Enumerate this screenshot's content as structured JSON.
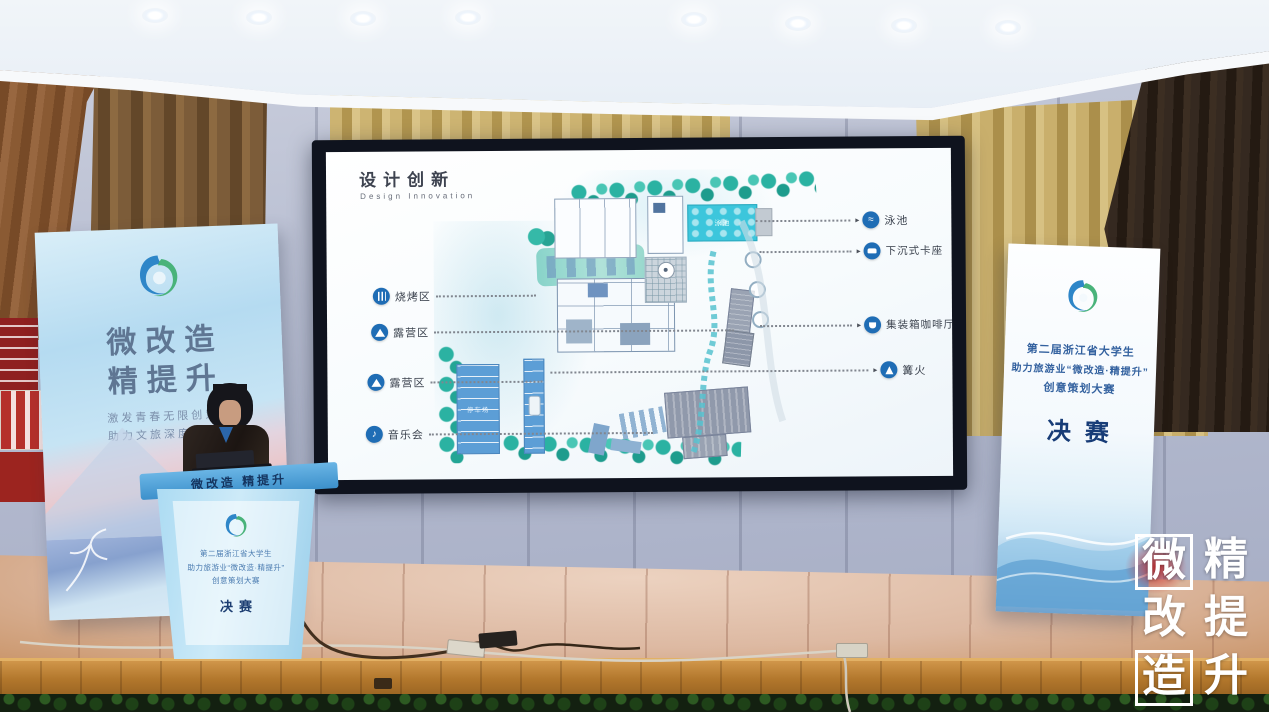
{
  "slide": {
    "title": "设计创新",
    "subtitle": "Design Innovation",
    "left_labels": [
      {
        "icon": "grill-icon",
        "label": "烧烤区"
      },
      {
        "icon": "tent-icon",
        "label": "露营区"
      },
      {
        "icon": "tent-icon",
        "label": "露营区"
      },
      {
        "icon": "music-icon",
        "label": "音乐会"
      }
    ],
    "right_labels": [
      {
        "icon": "swim-icon",
        "label": "泳池"
      },
      {
        "icon": "seat-icon",
        "label": "下沉式卡座"
      },
      {
        "icon": "coffee-icon",
        "label": "集装箱咖啡厅"
      },
      {
        "icon": "fire-icon",
        "label": "篝火"
      }
    ],
    "plan": {
      "pool_label": "泳池",
      "parking_label": "停车场"
    },
    "icon_glyphs": {
      "music": "♪",
      "swim": "≈"
    }
  },
  "banner_left": {
    "title_line1": "微改造",
    "title_line2": "精提升",
    "tagline_line1": "激发青春无限创意",
    "tagline_line2": "助力文旅深度融合"
  },
  "banner_right": {
    "line1": "第二届浙江省大学生",
    "line2": "助力旅游业“微改造·精提升”",
    "line3": "创意策划大赛",
    "final_label": "决赛"
  },
  "podium": {
    "band_text": "微改造 精提升",
    "line1": "第二届浙江省大学生",
    "line2": "助力旅游业“微改造·精提升”",
    "line3": "创意策划大赛",
    "final_label": "决赛"
  },
  "watermark": {
    "left_col": [
      "微",
      "改",
      "造"
    ],
    "right_col": [
      "精",
      "提",
      "升"
    ]
  },
  "colors": {
    "label_icon_blue": "#1f6db5",
    "banner_blue": "#aed6ee",
    "podium_blue": "#4a9cd4",
    "stage_wood": "#c08049",
    "plan_teal": "#35b5a6",
    "pool_cyan": "#3cc4da"
  }
}
